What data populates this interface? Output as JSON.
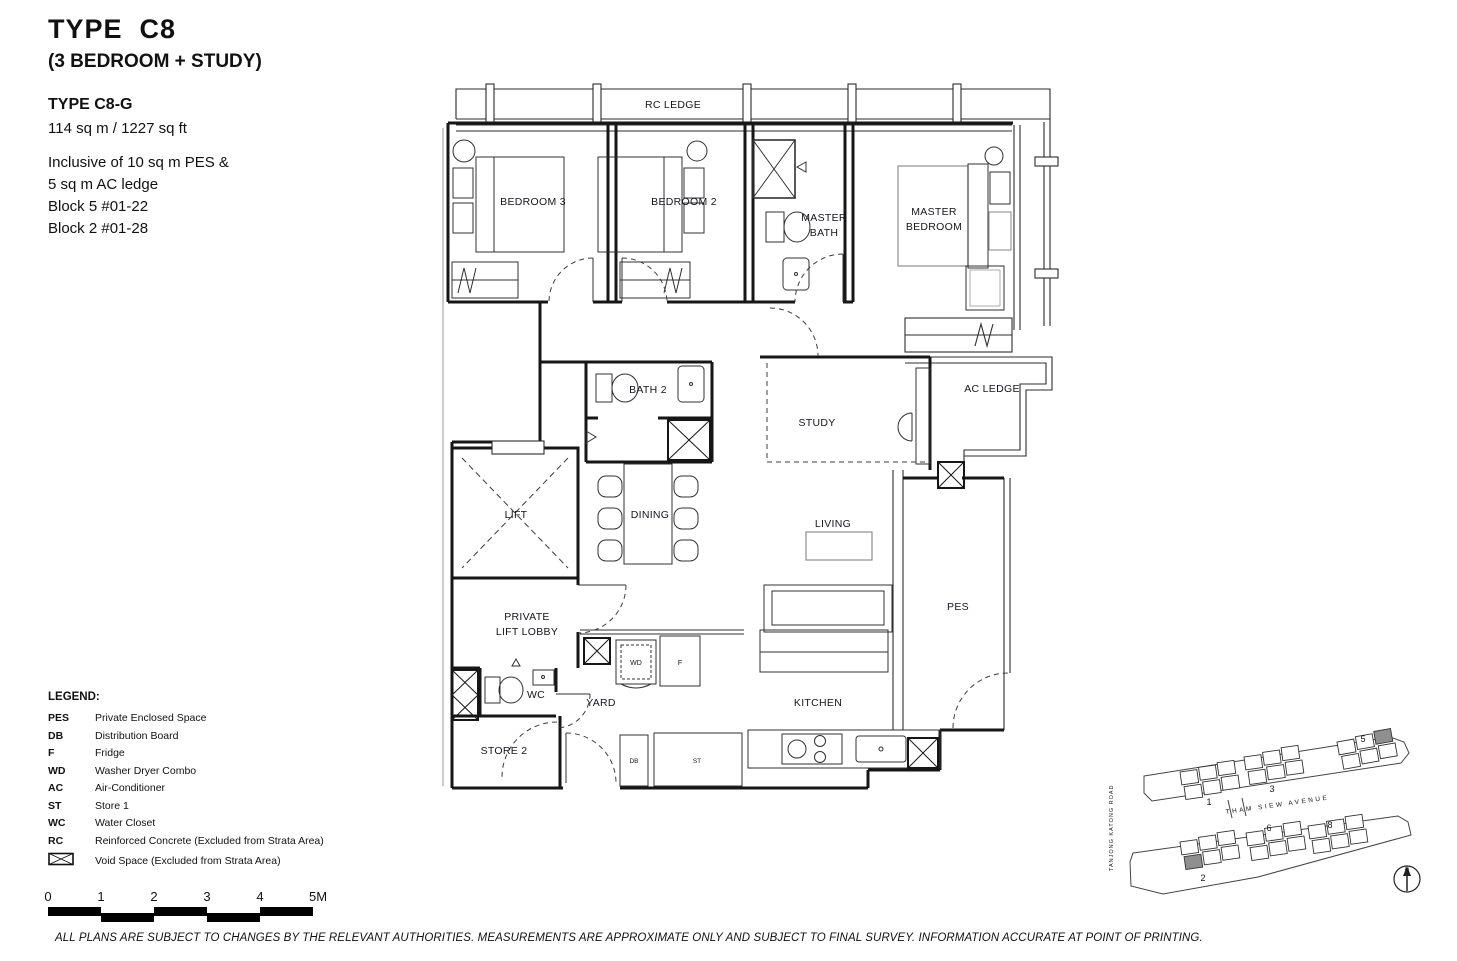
{
  "header": {
    "type_title": "TYPE  C8",
    "subtitle": "(3 BEDROOM + STUDY)",
    "variant": "TYPE C8-G",
    "area": "114 sq m / 1227 sq ft",
    "notes": [
      "Inclusive of 10 sq m PES &",
      "5 sq m AC ledge",
      "Block 5 #01-22",
      "Block 2 #01-28"
    ]
  },
  "plan": {
    "rooms": {
      "rc_ledge": "RC LEDGE",
      "bedroom3": "BEDROOM 3",
      "bedroom2": "BEDROOM 2",
      "master_bath1": "MASTER",
      "master_bath2": "BATH",
      "master_bedroom1": "MASTER",
      "master_bedroom2": "BEDROOM",
      "bath2": "BATH 2",
      "study": "STUDY",
      "ac_ledge": "AC LEDGE",
      "dining": "DINING",
      "living": "LIVING",
      "lift": "LIFT",
      "pll1": "PRIVATE",
      "pll2": "LIFT LOBBY",
      "pes": "PES",
      "wc": "WC",
      "yard": "YARD",
      "kitchen": "KITCHEN",
      "store2": "STORE 2",
      "wd": "WD",
      "f": "F",
      "db": "DB",
      "st": "ST"
    }
  },
  "legend": {
    "title": "LEGEND:",
    "items": [
      {
        "abbr": "PES",
        "desc": "Private Enclosed Space"
      },
      {
        "abbr": "DB",
        "desc": "Distribution Board"
      },
      {
        "abbr": "F",
        "desc": "Fridge"
      },
      {
        "abbr": "WD",
        "desc": "Washer Dryer Combo"
      },
      {
        "abbr": "AC",
        "desc": "Air-Conditioner"
      },
      {
        "abbr": "ST",
        "desc": "Store 1"
      },
      {
        "abbr": "WC",
        "desc": "Water Closet"
      },
      {
        "abbr": "RC",
        "desc": "Reinforced Concrete (Excluded from Strata Area)"
      },
      {
        "abbr": "",
        "desc": "Void Space (Excluded from Strata Area)"
      }
    ]
  },
  "scale_bar": {
    "labels": [
      "0",
      "1",
      "2",
      "3",
      "4",
      "5M"
    ]
  },
  "site_plan": {
    "block_labels": [
      "1",
      "3",
      "5",
      "2",
      "6",
      "8"
    ],
    "road_center": "THAM  SIEW  AVENUE",
    "road_left": "TANJONG  KATONG  ROAD",
    "compass": "N"
  },
  "footer": {
    "disclaimer": "ALL PLANS ARE SUBJECT TO CHANGES BY THE RELEVANT AUTHORITIES. MEASUREMENTS ARE APPROXIMATE ONLY AND SUBJECT TO FINAL SURVEY. INFORMATION ACCURATE AT POINT OF PRINTING."
  }
}
